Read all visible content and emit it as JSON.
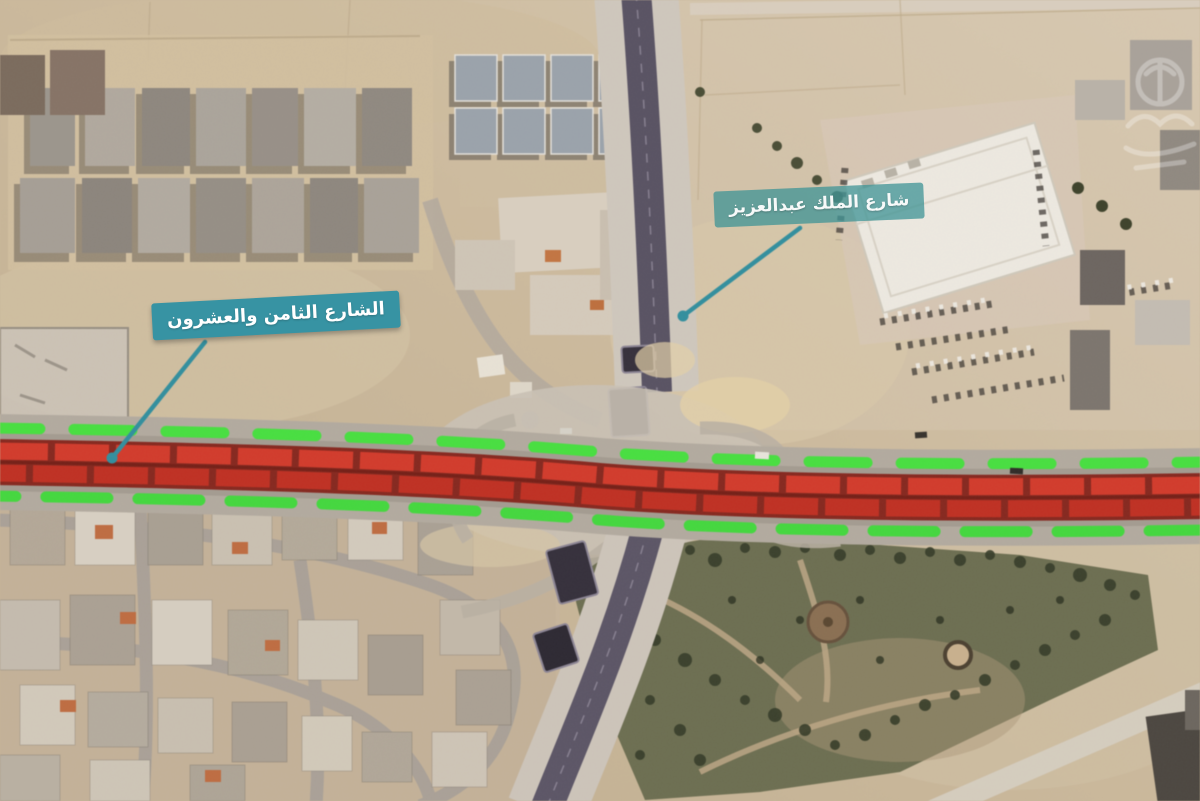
{
  "map": {
    "annotations": [
      {
        "id": "street-28",
        "label": "الشارع الثامن والعشرون"
      },
      {
        "id": "king-abdulaziz-street",
        "label": "شارع الملك عبدالعزيز"
      }
    ],
    "overlay_colors": {
      "callout_teal": "#3793a3",
      "congestion_red": "#d63829",
      "free_flow_green": "#43e03c"
    },
    "icons": {
      "watermark": "faint-emblem-watermark",
      "leader_dot": "callout-anchor-dot"
    }
  }
}
